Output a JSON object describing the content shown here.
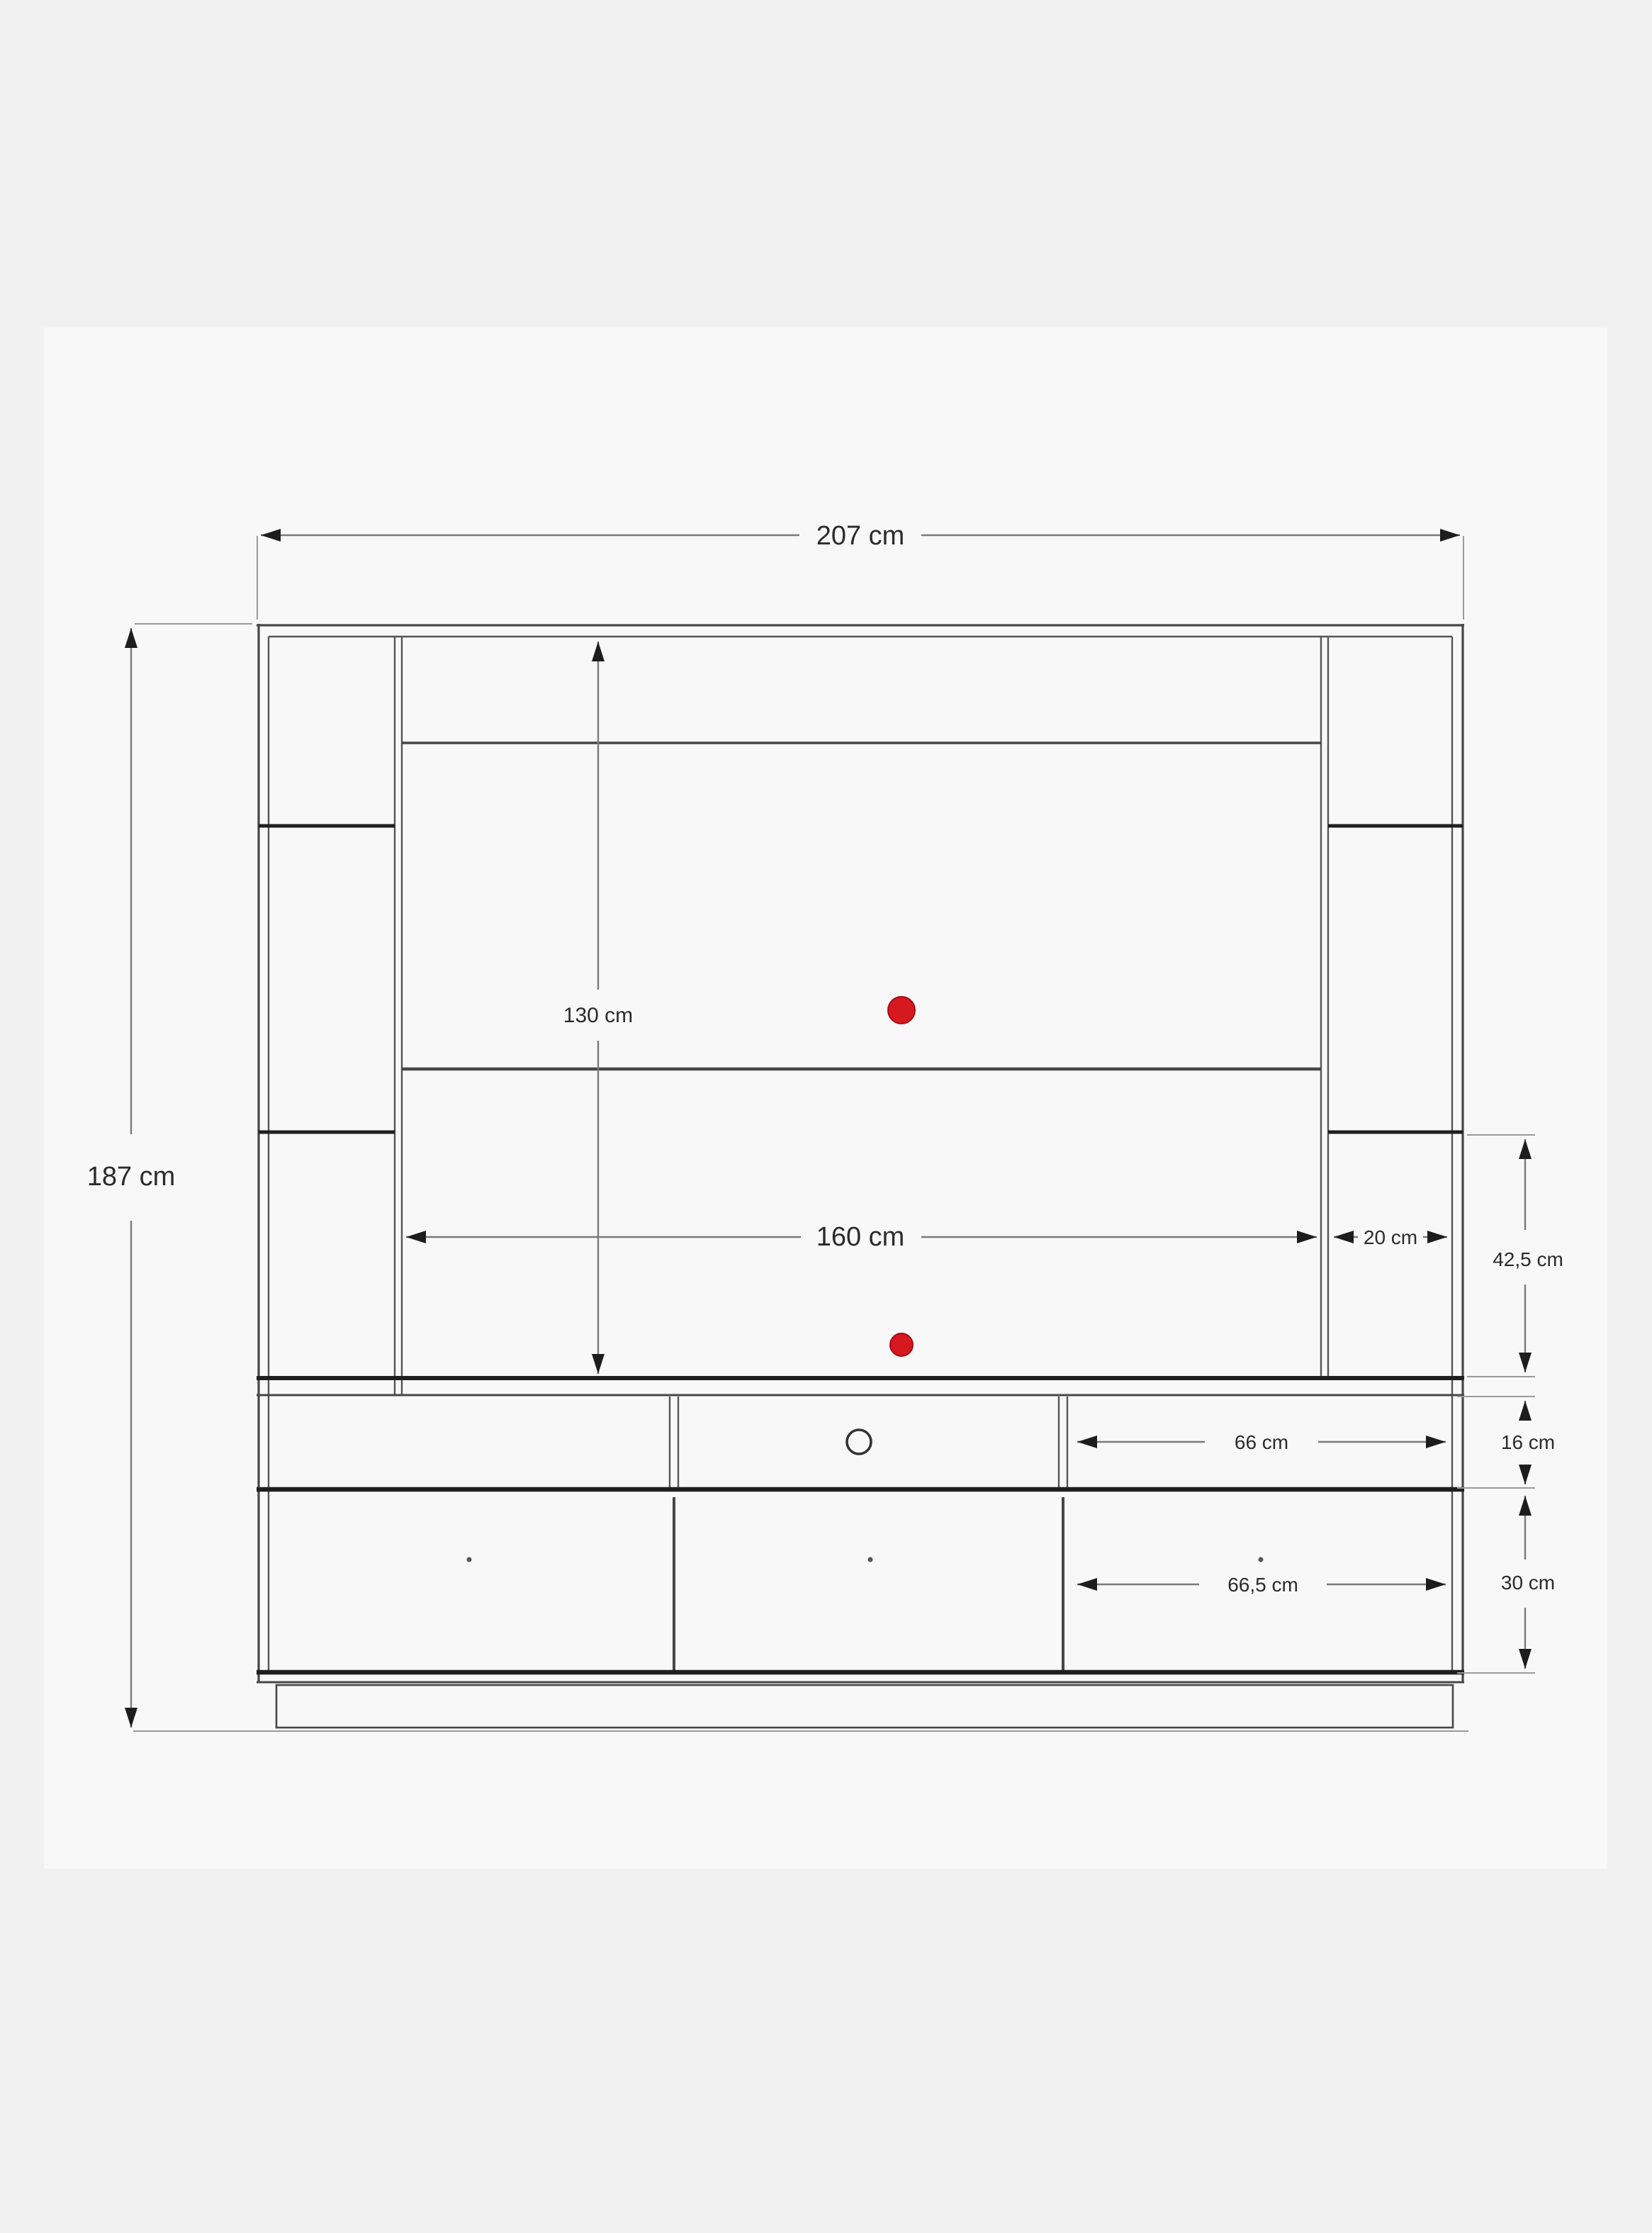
{
  "diagram": {
    "type": "furniture-dimension-drawing",
    "subject": "TV wall unit / entertainment center front elevation with dimensions",
    "units": "cm",
    "colors": {
      "background": "#f1f1f1",
      "panel": "#f8f8f8",
      "structure_line": "#474747",
      "bold_line": "#1f1f1f",
      "dimension_line": "#7a7a7a",
      "text": "#2b2b2b",
      "accent_red": "#d6181f"
    },
    "dimensions": {
      "total_width": {
        "label": "207 cm",
        "value": 207
      },
      "total_height": {
        "label": "187 cm",
        "value": 187
      },
      "back_panel_height": {
        "label": "130 cm",
        "value": 130
      },
      "tv_opening_width": {
        "label": "160 cm",
        "value": 160
      },
      "side_column_width": {
        "label": "20 cm",
        "value": 20
      },
      "side_niche_height": {
        "label": "42,5 cm",
        "value": 42.5
      },
      "shelf_row_height": {
        "label": "16 cm",
        "value": 16
      },
      "shelf_opening_width": {
        "label": "66 cm",
        "value": 66
      },
      "drawer_height": {
        "label": "30 cm",
        "value": 30
      },
      "drawer_width": {
        "label": "66,5 cm",
        "value": 66.5
      }
    },
    "features": {
      "cable_hole_markers": "2 red dots on back panel",
      "center_handle": "circle cut-out on middle shelf compartment",
      "drawer_knobs": "3 small dots on lower drawer fronts"
    }
  }
}
